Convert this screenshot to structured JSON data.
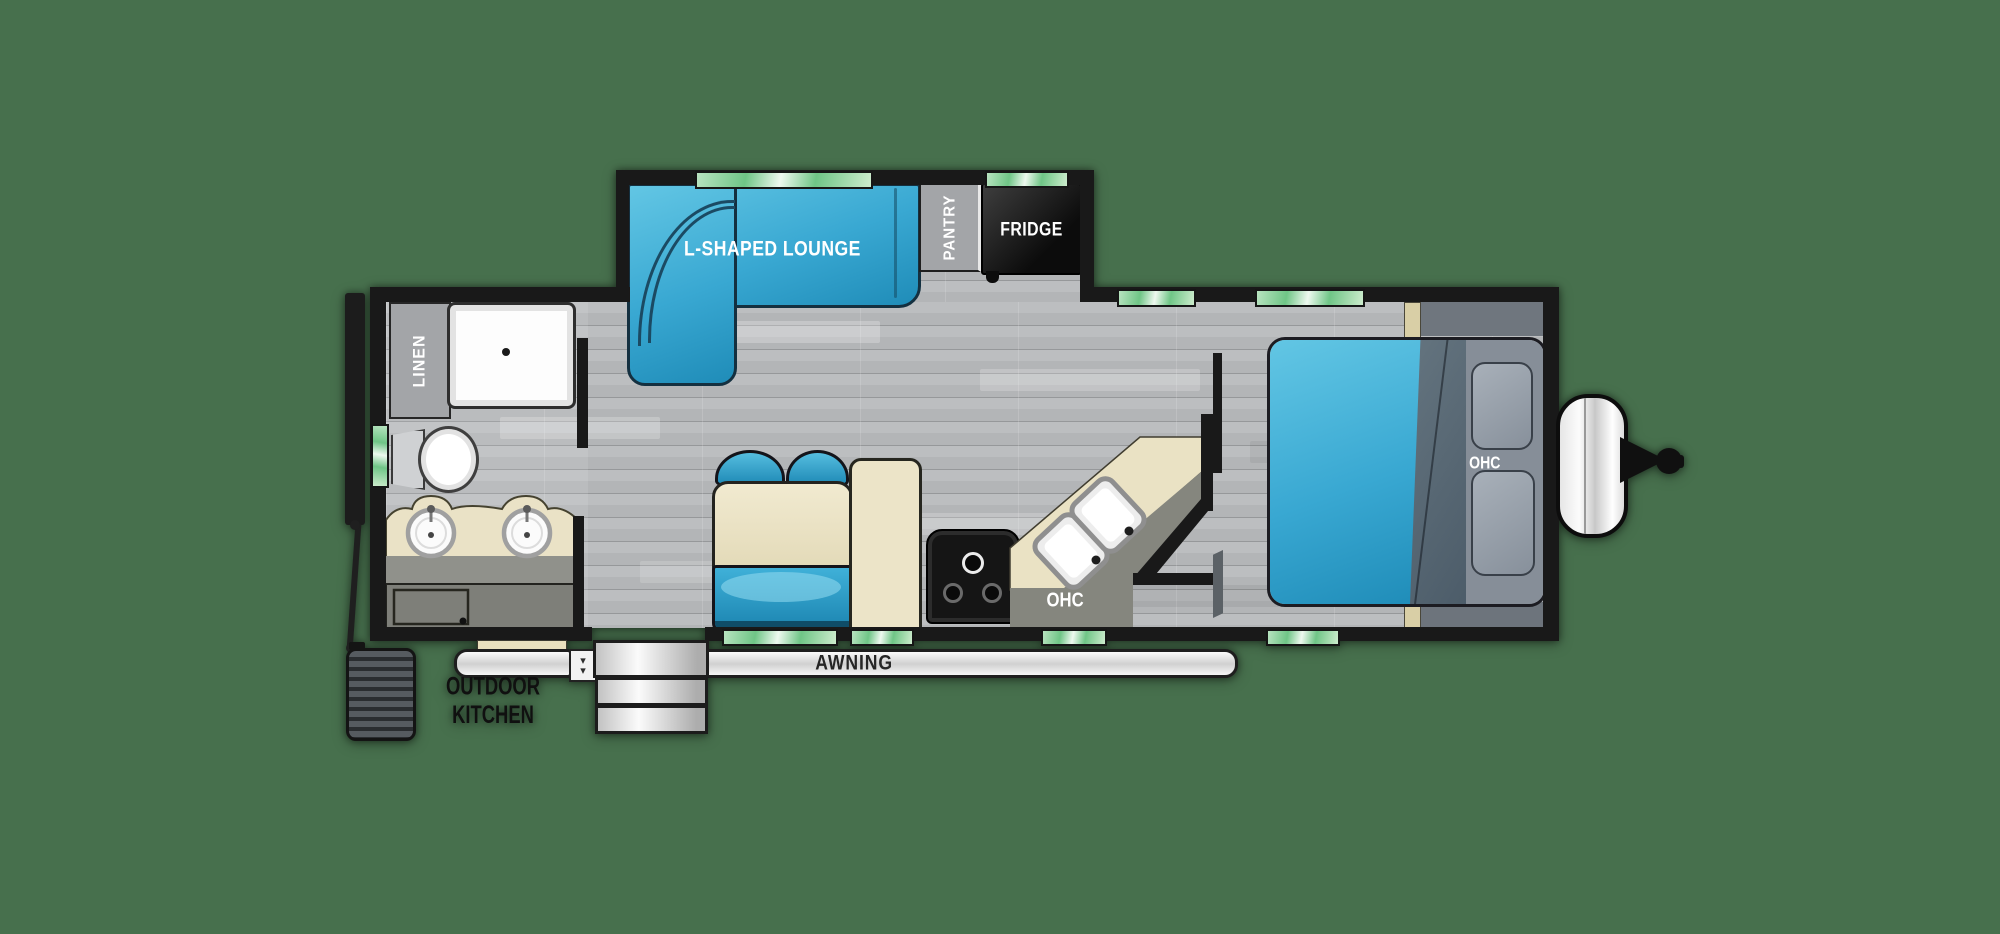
{
  "title": "Travel trailer floor plan",
  "background_color": "#47704d",
  "labels": {
    "lounge": "L-SHAPED LOUNGE",
    "pantry": "PANTRY",
    "fridge": "FRIDGE",
    "linen": "LINEN",
    "kitchen_ohc": "OHC",
    "bedroom_ohc": "OHC",
    "awning": "AWNING",
    "outdoor_kitchen_line1": "OUTDOOR",
    "outdoor_kitchen_line2": "KITCHEN"
  },
  "icons": {
    "chevron_down": "▾"
  },
  "colors": {
    "background": "#47704d",
    "wall": "#191919",
    "floor_plank": "#b1b3b5",
    "window_green": "#6fc586",
    "sofa_blue": "#39a8d2",
    "bed_blue": "#39a8d2",
    "upholstery_cream": "#ece4c8",
    "counter_cream": "#eae2c4",
    "cabinet_gray": "#a3a5a8",
    "fridge_black": "#1b1b1b",
    "pillow_gray": "#9aa2ac",
    "tan_accent": "#d9cfa6"
  }
}
